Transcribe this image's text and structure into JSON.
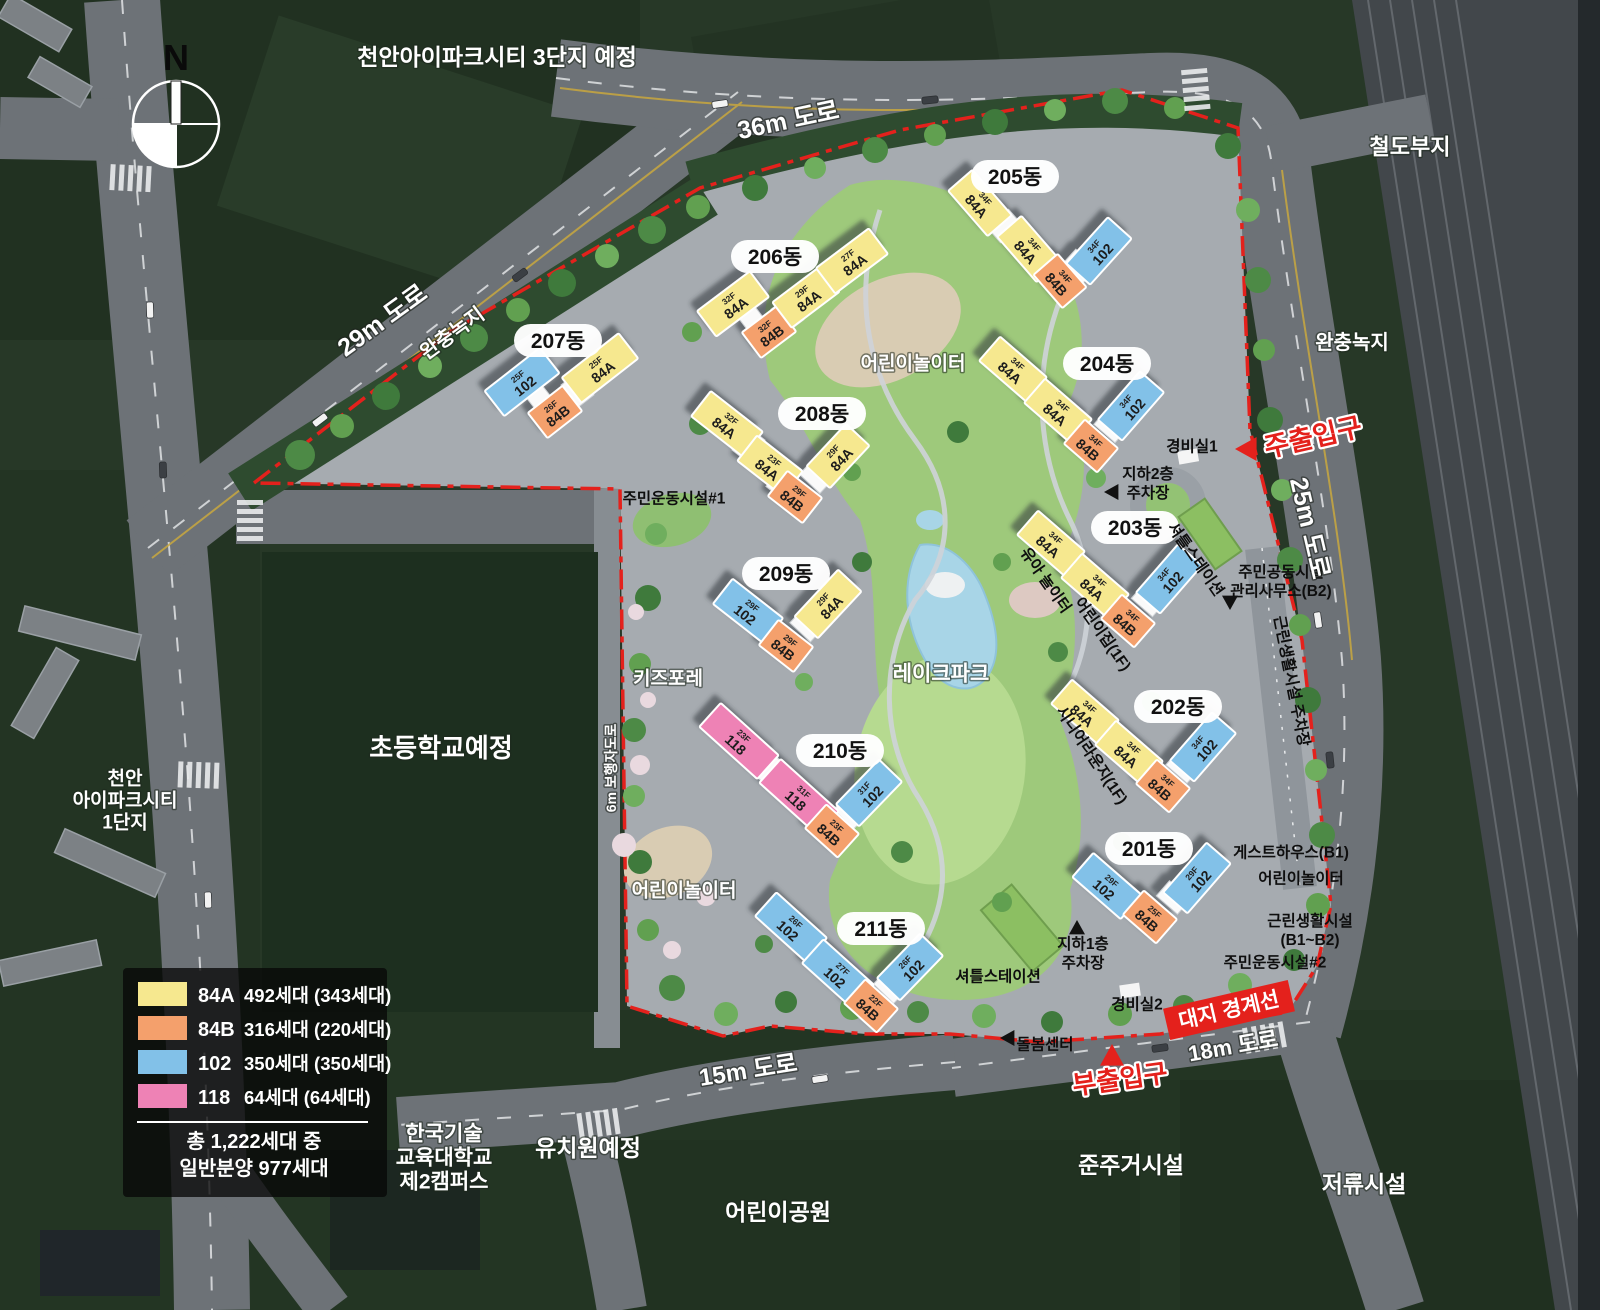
{
  "colors": {
    "84A": "#F6E88F",
    "84B": "#F4A06C",
    "102": "#82C1E8",
    "118": "#EE82B5",
    "red": "#E4211C"
  },
  "compass": {
    "label": "N"
  },
  "legend": {
    "items": [
      {
        "code": "84A",
        "count": "492세대 (343세대)"
      },
      {
        "code": "84B",
        "count": "316세대 (220세대)"
      },
      {
        "code": "102",
        "count": "350세대 (350세대)"
      },
      {
        "code": "118",
        "count": "64세대 (64세대)"
      }
    ],
    "total_line1": "총 1,222세대 중",
    "total_line2": "일반분양 977세대"
  },
  "areas": [
    {
      "text": "천안아이파크시티 3단지 예정",
      "x": 497,
      "y": 57,
      "s": 23
    },
    {
      "text": "철도부지",
      "x": 1410,
      "y": 147,
      "s": 22
    },
    {
      "text": "완충녹지",
      "x": 1352,
      "y": 342,
      "s": 20
    },
    {
      "text": "완충녹지",
      "x": 452,
      "y": 333,
      "s": 20,
      "rot": -36
    },
    {
      "text": "초등학교예정",
      "x": 441,
      "y": 748,
      "s": 26
    },
    {
      "lines": [
        "천안",
        "아이파크시티",
        "1단지"
      ],
      "x": 125,
      "y": 800,
      "s": 19,
      "lh": 22
    },
    {
      "text": "어린이놀이터",
      "x": 913,
      "y": 363,
      "s": 19
    },
    {
      "text": "레이크파크",
      "x": 941,
      "y": 673,
      "s": 21
    },
    {
      "text": "키즈포레",
      "x": 668,
      "y": 678,
      "s": 19
    },
    {
      "text": "어린이놀이터",
      "x": 684,
      "y": 890,
      "s": 19
    },
    {
      "text": "유치원예정",
      "x": 588,
      "y": 1148,
      "s": 23
    },
    {
      "text": "어린이공원",
      "x": 778,
      "y": 1212,
      "s": 23
    },
    {
      "text": "준주거시설",
      "x": 1131,
      "y": 1165,
      "s": 23
    },
    {
      "text": "저류시설",
      "x": 1364,
      "y": 1184,
      "s": 23
    },
    {
      "lines": [
        "한국기술",
        "교육대학교",
        "제2캠퍼스"
      ],
      "x": 444,
      "y": 1157,
      "s": 21,
      "lh": 24
    }
  ],
  "road_labels": [
    {
      "text": "36m 도로",
      "x": 788,
      "y": 120,
      "rot": -12,
      "s": 25
    },
    {
      "text": "29m 도로",
      "x": 382,
      "y": 320,
      "rot": -36,
      "s": 25
    },
    {
      "text": "25m 도로",
      "x": 1310,
      "y": 528,
      "rot": 77,
      "s": 25
    },
    {
      "text": "15m 도로",
      "x": 748,
      "y": 1070,
      "rot": -9,
      "s": 24
    },
    {
      "text": "18m 도로",
      "x": 1233,
      "y": 1046,
      "rot": -10,
      "s": 22
    },
    {
      "text": "6m 보행자도로",
      "x": 611,
      "y": 768,
      "rot": -90,
      "s": 14
    }
  ],
  "facilities": [
    {
      "text": "주민운동시설#1",
      "x": 674,
      "y": 498
    },
    {
      "text": "경비실1",
      "x": 1192,
      "y": 446
    },
    {
      "lines": [
        "지하2층",
        "주차장"
      ],
      "x": 1148,
      "y": 483,
      "tri": {
        "x": 1112,
        "y": 492,
        "dir": "left"
      }
    },
    {
      "text": "셔틀스테이션",
      "x": 1196,
      "y": 559,
      "rot": 55
    },
    {
      "lines": [
        "주민공동시설",
        "관리사무소(B2)"
      ],
      "x": 1281,
      "y": 581,
      "tri": {
        "x": 1230,
        "y": 602,
        "dir": "down"
      }
    },
    {
      "text": "근린생활시설 주차장",
      "x": 1292,
      "y": 681,
      "rot": 79
    },
    {
      "text": "유아 놀이터",
      "x": 1046,
      "y": 580,
      "rot": 55
    },
    {
      "text": "어린이집(1F)",
      "x": 1103,
      "y": 634,
      "rot": 55
    },
    {
      "text": "시니어라운지(1F)",
      "x": 1092,
      "y": 755,
      "rot": 56
    },
    {
      "text": "게스트하우스(B1)",
      "x": 1291,
      "y": 852
    },
    {
      "text": "어린이놀이터",
      "x": 1301,
      "y": 878
    },
    {
      "lines": [
        "근린생활시설",
        "(B1~B2)"
      ],
      "x": 1310,
      "y": 930
    },
    {
      "text": "주민운동시설#2",
      "x": 1275,
      "y": 962
    },
    {
      "lines": [
        "지하1층",
        "주차장"
      ],
      "x": 1083,
      "y": 953,
      "tri": {
        "x": 1077,
        "y": 928,
        "dir": "up"
      }
    },
    {
      "text": "셔틀스테이션",
      "x": 998,
      "y": 976
    },
    {
      "text": "경비실2",
      "x": 1137,
      "y": 1004
    },
    {
      "text": "돌봄센터",
      "x": 1045,
      "y": 1044,
      "tri": {
        "x": 1008,
        "y": 1038,
        "dir": "left"
      }
    }
  ],
  "entrances": [
    {
      "text": "주출입구",
      "x": 1313,
      "y": 437,
      "rot": -13,
      "s": 27,
      "tri": {
        "x": 1247,
        "y": 449,
        "dir": "left"
      }
    },
    {
      "text": "부출입구",
      "x": 1120,
      "y": 1079,
      "rot": -8,
      "s": 26,
      "tri": {
        "x": 1112,
        "y": 1056,
        "dir": "up"
      }
    }
  ],
  "boundary_badge": {
    "text": "대지 경계선",
    "x": 1229,
    "y": 1010,
    "rot": -13
  },
  "buildings": [
    {
      "name": "201동",
      "pill": {
        "x": 1149,
        "y": 849
      },
      "segments": [
        {
          "type": "102",
          "floors": "29F",
          "cx": 1107,
          "cy": 886,
          "rot": 41,
          "len": 64
        },
        {
          "type": "84B",
          "floors": "25F",
          "cx": 1150,
          "cy": 917,
          "rot": 41,
          "len": 44
        },
        {
          "type": "102",
          "floors": "29F",
          "cx": 1197,
          "cy": 878,
          "rot": -49,
          "len": 66
        }
      ]
    },
    {
      "name": "202동",
      "pill": {
        "x": 1178,
        "y": 707
      },
      "segments": [
        {
          "type": "84A",
          "floors": "34F",
          "cx": 1085,
          "cy": 712,
          "rot": 41,
          "len": 62
        },
        {
          "type": "84A",
          "floors": "34F",
          "cx": 1129,
          "cy": 753,
          "rot": 41,
          "len": 62
        },
        {
          "type": "84B",
          "floors": "34F",
          "cx": 1163,
          "cy": 786,
          "rot": 41,
          "len": 44
        },
        {
          "type": "102",
          "floors": "34F",
          "cx": 1203,
          "cy": 747,
          "rot": -49,
          "len": 64
        }
      ]
    },
    {
      "name": "203동",
      "pill": {
        "x": 1135,
        "y": 528
      },
      "segments": [
        {
          "type": "84A",
          "floors": "34F",
          "cx": 1051,
          "cy": 543,
          "rot": 41,
          "len": 62
        },
        {
          "type": "84A",
          "floors": "34F",
          "cx": 1095,
          "cy": 586,
          "rot": 41,
          "len": 62
        },
        {
          "type": "84B",
          "floors": "34F",
          "cx": 1128,
          "cy": 621,
          "rot": 41,
          "len": 44
        },
        {
          "type": "102",
          "floors": "34F",
          "cx": 1169,
          "cy": 579,
          "rot": -49,
          "len": 64
        }
      ]
    },
    {
      "name": "204동",
      "pill": {
        "x": 1107,
        "y": 364
      },
      "segments": [
        {
          "type": "84A",
          "floors": "34F",
          "cx": 1013,
          "cy": 369,
          "rot": 41,
          "len": 62
        },
        {
          "type": "84A",
          "floors": "34F",
          "cx": 1058,
          "cy": 411,
          "rot": 41,
          "len": 62
        },
        {
          "type": "84B",
          "floors": "34F",
          "cx": 1091,
          "cy": 446,
          "rot": 41,
          "len": 44
        },
        {
          "type": "102",
          "floors": "34F",
          "cx": 1131,
          "cy": 406,
          "rot": -49,
          "len": 64
        }
      ]
    },
    {
      "name": "205동",
      "pill": {
        "x": 1015,
        "y": 177
      },
      "segments": [
        {
          "type": "84A",
          "floors": "34F",
          "cx": 980,
          "cy": 203,
          "rot": 49,
          "len": 60
        },
        {
          "type": "84A",
          "floors": "34F",
          "cx": 1029,
          "cy": 249,
          "rot": 49,
          "len": 60
        },
        {
          "type": "84B",
          "floors": "34F",
          "cx": 1060,
          "cy": 281,
          "rot": 49,
          "len": 44
        },
        {
          "type": "102",
          "floors": "34F",
          "cx": 1099,
          "cy": 251,
          "rot": -48,
          "len": 62
        }
      ]
    },
    {
      "name": "206동",
      "pill": {
        "x": 775,
        "y": 257
      },
      "segments": [
        {
          "type": "84A",
          "floors": "32F",
          "cx": 733,
          "cy": 304,
          "rot": -37,
          "len": 66
        },
        {
          "type": "84B",
          "floors": "32F",
          "cx": 769,
          "cy": 332,
          "rot": -37,
          "len": 44
        },
        {
          "type": "84A",
          "floors": "29F",
          "cx": 806,
          "cy": 297,
          "rot": -37,
          "len": 60
        },
        {
          "type": "84A",
          "floors": "27F",
          "cx": 852,
          "cy": 261,
          "rot": -37,
          "len": 66
        }
      ]
    },
    {
      "name": "207동",
      "pill": {
        "x": 558,
        "y": 341
      },
      "segments": [
        {
          "type": "102",
          "floors": "25F",
          "cx": 522,
          "cy": 382,
          "rot": -38,
          "len": 70
        },
        {
          "type": "84B",
          "floors": "26F",
          "cx": 555,
          "cy": 412,
          "rot": -38,
          "len": 44
        },
        {
          "type": "84A",
          "floors": "25F",
          "cx": 600,
          "cy": 368,
          "rot": -38,
          "len": 72
        }
      ]
    },
    {
      "name": "208동",
      "pill": {
        "x": 822,
        "y": 414
      },
      "segments": [
        {
          "type": "84A",
          "floors": "32F",
          "cx": 727,
          "cy": 424,
          "rot": 38,
          "len": 66
        },
        {
          "type": "84A",
          "floors": "23F",
          "cx": 770,
          "cy": 466,
          "rot": 38,
          "len": 58
        },
        {
          "type": "84B",
          "floors": "29F",
          "cx": 795,
          "cy": 497,
          "rot": 38,
          "len": 44
        },
        {
          "type": "84A",
          "floors": "29F",
          "cx": 838,
          "cy": 456,
          "rot": -47,
          "len": 58
        }
      ]
    },
    {
      "name": "209동",
      "pill": {
        "x": 786,
        "y": 574
      },
      "segments": [
        {
          "type": "102",
          "floors": "29F",
          "cx": 748,
          "cy": 611,
          "rot": 38,
          "len": 64
        },
        {
          "type": "84B",
          "floors": "29F",
          "cx": 786,
          "cy": 646,
          "rot": 38,
          "len": 44
        },
        {
          "type": "84A",
          "floors": "29F",
          "cx": 828,
          "cy": 604,
          "rot": -47,
          "len": 64
        }
      ]
    },
    {
      "name": "210동",
      "pill": {
        "x": 840,
        "y": 751
      },
      "segments": [
        {
          "type": "118",
          "floors": "23F",
          "cx": 739,
          "cy": 741,
          "rot": 42,
          "len": 78
        },
        {
          "type": "118",
          "floors": "31F",
          "cx": 799,
          "cy": 797,
          "rot": 42,
          "len": 78
        },
        {
          "type": "84B",
          "floors": "23F",
          "cx": 832,
          "cy": 831,
          "rot": 42,
          "len": 44
        },
        {
          "type": "102",
          "floors": "31F",
          "cx": 869,
          "cy": 793,
          "rot": -46,
          "len": 62
        }
      ]
    },
    {
      "name": "211동",
      "pill": {
        "x": 881,
        "y": 929
      },
      "segments": [
        {
          "type": "102",
          "floors": "26F",
          "cx": 791,
          "cy": 927,
          "rot": 42,
          "len": 68
        },
        {
          "type": "102",
          "floors": "27F",
          "cx": 838,
          "cy": 974,
          "rot": 42,
          "len": 68
        },
        {
          "type": "84B",
          "floors": "22F",
          "cx": 871,
          "cy": 1006,
          "rot": 42,
          "len": 44
        },
        {
          "type": "102",
          "floors": "26F",
          "cx": 910,
          "cy": 967,
          "rot": -46,
          "len": 62
        }
      ]
    }
  ]
}
